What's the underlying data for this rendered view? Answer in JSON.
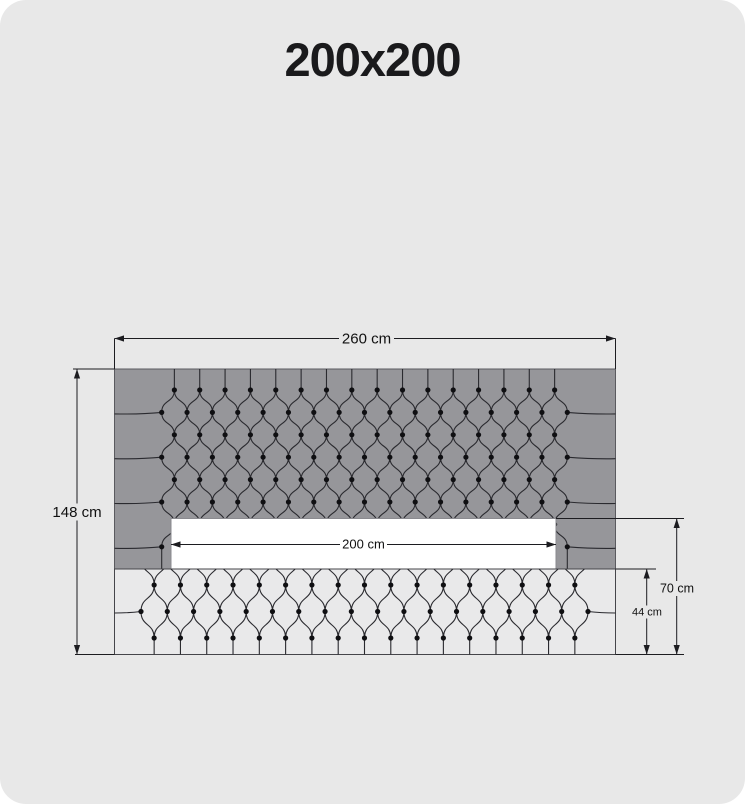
{
  "title": "200x200",
  "diagram": {
    "dimensions": {
      "total_width": "260 cm",
      "total_height": "148 cm",
      "inner_width": "200 cm",
      "mattress_height": "70 cm",
      "base_height": "44 cm"
    },
    "colors": {
      "page_background": "#e8e8e8",
      "headboard_fill": "#96969a",
      "base_fill": "#e9e9ea",
      "cutout_fill": "#ffffff",
      "line": "#2a2a2f",
      "button": "#0f0f12",
      "dimension_line": "#1c1c20",
      "text": "#111111"
    }
  }
}
